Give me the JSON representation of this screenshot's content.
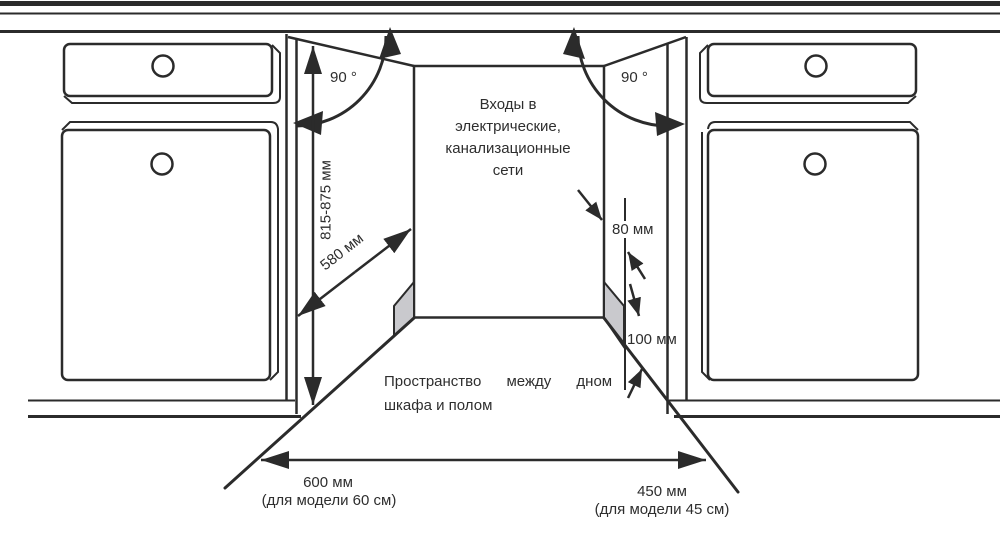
{
  "diagram": {
    "labels": {
      "angle_left": "90 °",
      "angle_right": "90 °",
      "utilities": "Входы в\nэлектрические,\nканализационные\nсети",
      "niche_height": "815-875 мм",
      "niche_depth": "580 мм",
      "side_gap": "80 мм",
      "plinth_height": "100 мм",
      "floor_space_line1": "Пространство между дном",
      "floor_space_line2": "шкафа и полом",
      "width_60": "600 мм",
      "width_60_note": "(для модели 60 см)",
      "width_45": "450 мм",
      "width_45_note": "(для модели 45 см)"
    },
    "colors": {
      "line": "#2b2b2b",
      "text": "#2e2e2e",
      "shade": "#c9c9cd",
      "background": "#ffffff"
    }
  }
}
